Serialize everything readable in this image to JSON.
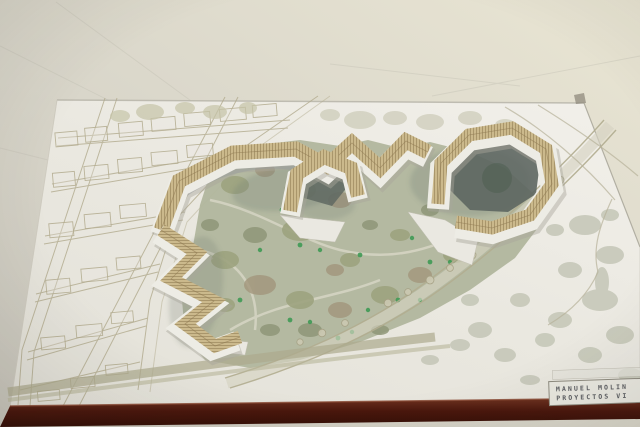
{
  "meta": {
    "type": "photograph",
    "subject": "architectural-site-model",
    "description": "Photo of a physical architecture site model on a table: white baseboard with drawn street grid at left, a sage-green park in the middle crossed by a diagonal tree-lined avenue, a chain of zig-zag wooden-roofed buildings snaking across the site, a ring-shaped building cluster at right, dark maroon board edge at the bottom, and a stamped title block at lower right."
  },
  "title_block": {
    "line1": "MANUEL MOLIN",
    "line2": "PROYECTOS VI"
  },
  "palette": {
    "table": "#d8d5c9",
    "board": "#ebe9e1",
    "board_edge": "#4a170d",
    "park": "#b1b69d",
    "tree_olive": "#9da37f",
    "tree_gray": "#b0b2a2",
    "tree_accent_green": "#3f9a55",
    "wood": "#cbb98c",
    "wood_slat": "#937e55",
    "walls": "#edece5",
    "courtyard_shadow": "#5d6660",
    "street_line": "#b2ab8e",
    "ink": "#43454b"
  }
}
